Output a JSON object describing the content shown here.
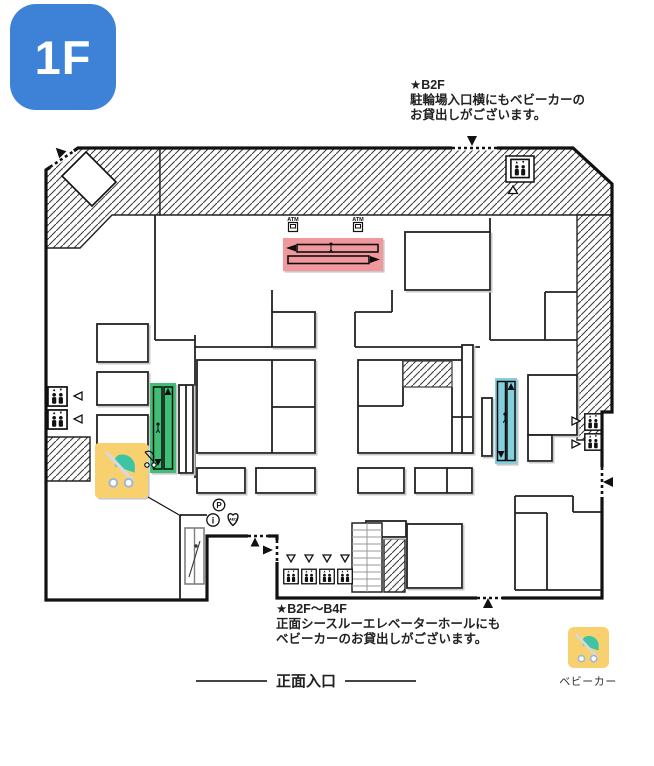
{
  "floor_badge": {
    "label": "1F"
  },
  "notes": {
    "top": {
      "line1": "★B2F",
      "line2": "駐輪場入口横にもベビーカーの",
      "line3": "お貸出しがございます。"
    },
    "bottom": {
      "line1": "★B2F〜B4F",
      "line2": "正面シースルーエレベーターホールにも",
      "line3": "ベビーカーのお貸出しがございます。"
    }
  },
  "entrance": {
    "label": "正面入口"
  },
  "legend": {
    "stroller_label": "ベビーカー"
  },
  "map_labels": {
    "atm": "ATM",
    "aed": "AED",
    "parking": "P",
    "information": "i"
  },
  "colors": {
    "badge": "#3D82D6",
    "escalator_red": "#F0989B",
    "escalator_green": "#3FBE74",
    "escalator_teal": "#85CEDB",
    "stroller_yellow": "#F8D06E",
    "stroller_basket": "#3EC4A4"
  }
}
